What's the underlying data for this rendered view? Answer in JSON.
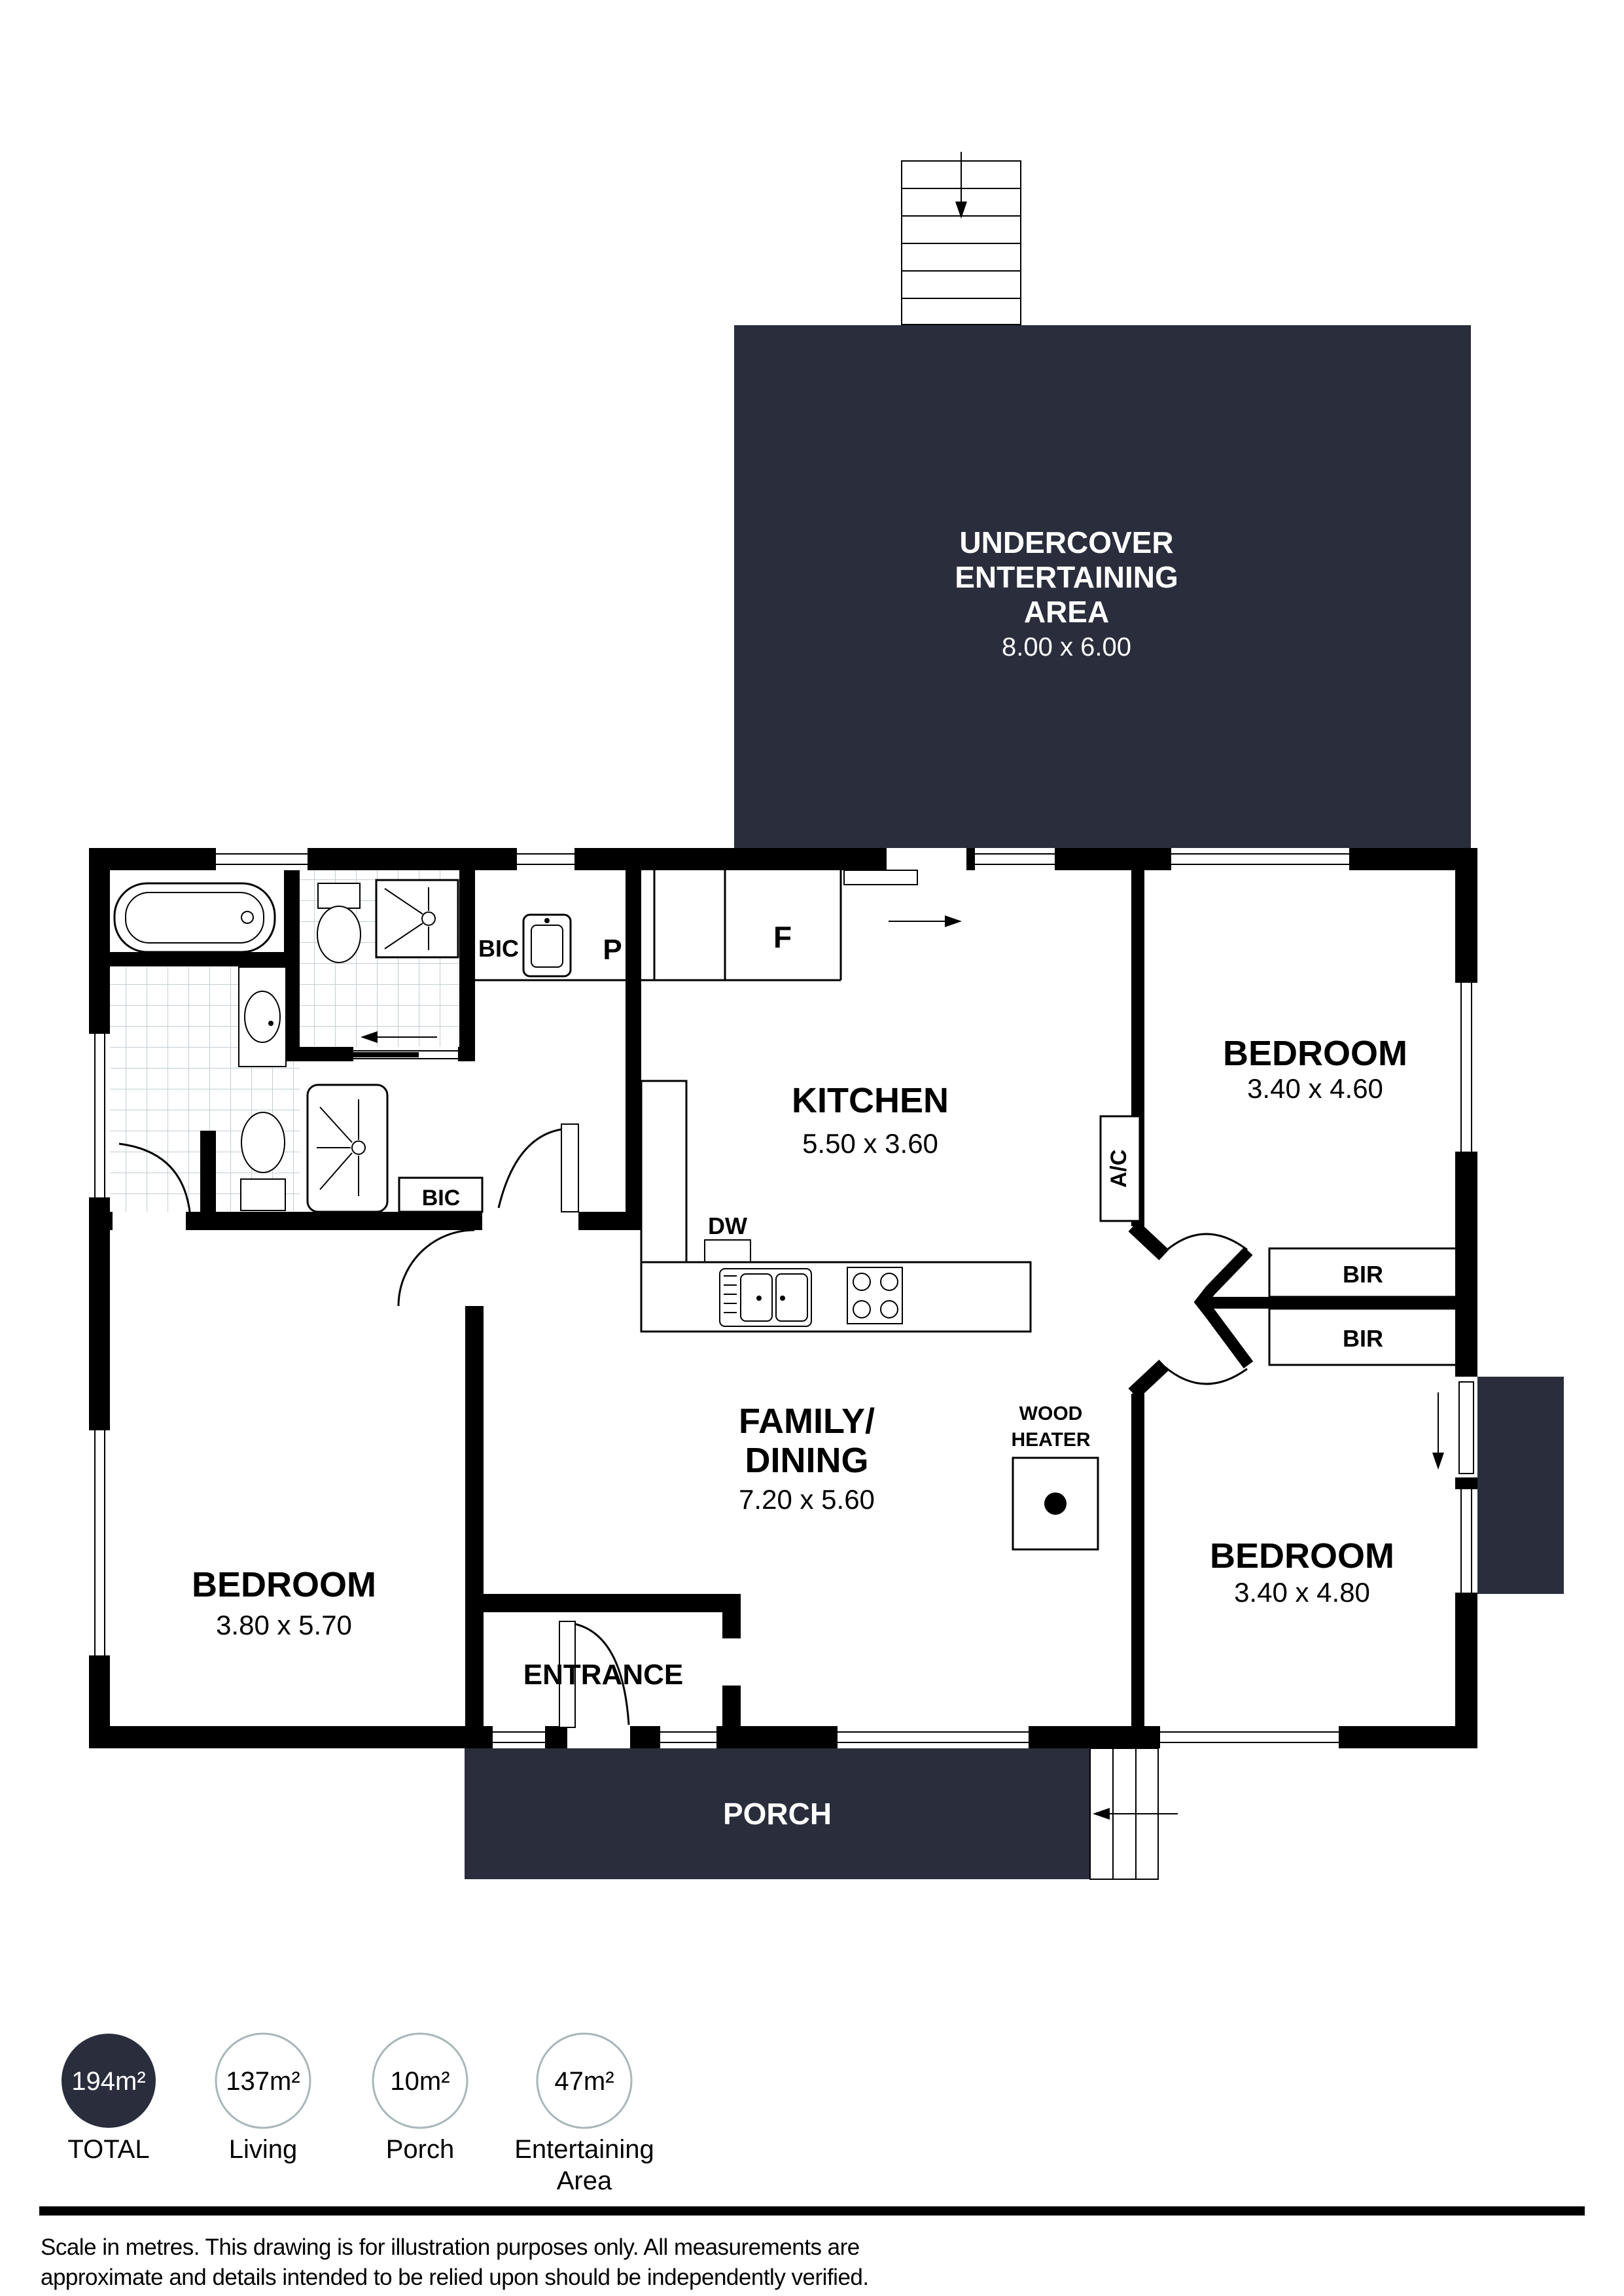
{
  "colors": {
    "dark": "#2a2d3c",
    "tile": "#c3ced2",
    "circle_border": "#a9b6ba"
  },
  "undercover": {
    "line1": "UNDERCOVER",
    "line2": "ENTERTAINING",
    "line3": "AREA",
    "dims": "8.00 x 6.00"
  },
  "rooms": {
    "kitchen": {
      "name": "KITCHEN",
      "dims": "5.50 x 3.60"
    },
    "family": {
      "name1": "FAMILY/",
      "name2": "DINING",
      "dims": "7.20 x 5.60"
    },
    "bedroom1": {
      "name": "BEDROOM",
      "dims": "3.40 x 4.60"
    },
    "bedroom2": {
      "name": "BEDROOM",
      "dims": "3.80 x 5.70"
    },
    "bedroom3": {
      "name": "BEDROOM",
      "dims": "3.40 x 4.80"
    },
    "entrance": {
      "name": "ENTRANCE"
    },
    "porch": {
      "name": "PORCH"
    }
  },
  "fixtures": {
    "bic_top": "BIC",
    "pantry": "P",
    "fridge": "F",
    "dishwasher": "DW",
    "ac": "A/C",
    "bic_hall": "BIC",
    "bir_top": "BIR",
    "bir_bottom": "BIR",
    "wood_heater_line1": "WOOD",
    "wood_heater_line2": "HEATER"
  },
  "legend": {
    "items": [
      {
        "value": "194m²",
        "label": "TOTAL",
        "filled": true
      },
      {
        "value": "137m²",
        "label": "Living",
        "filled": false
      },
      {
        "value": "10m²",
        "label": "Porch",
        "filled": false
      },
      {
        "value": "47m²",
        "label": "Entertaining",
        "label2": "Area",
        "filled": false
      }
    ]
  },
  "footer": {
    "line1": "Scale in metres. This drawing is for illustration purposes only. All measurements are",
    "line2": "approximate and details intended to be relied upon should be independently verified."
  }
}
